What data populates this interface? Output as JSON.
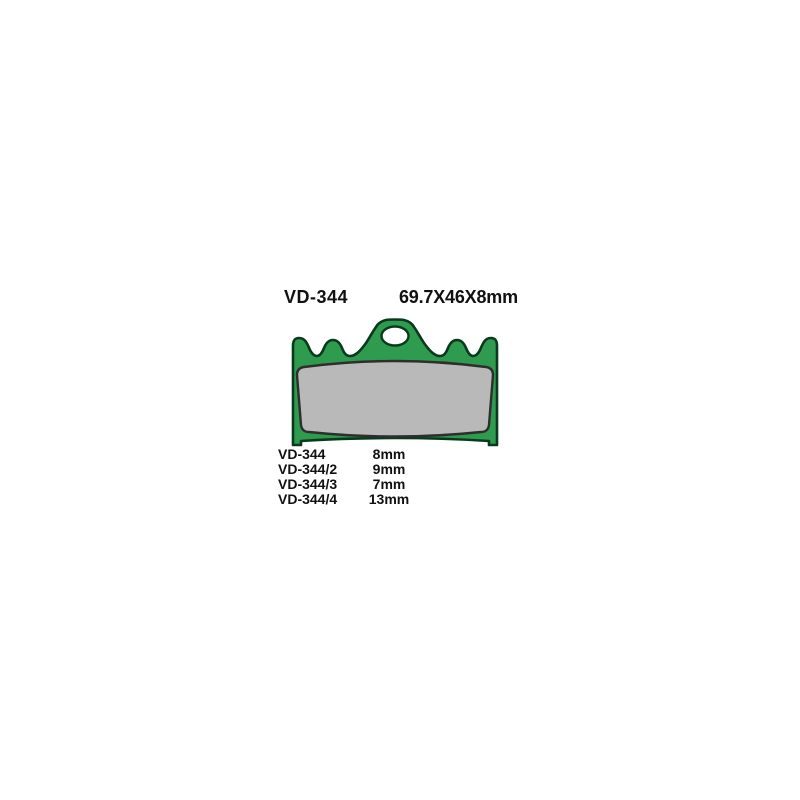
{
  "page": {
    "background": "#ffffff"
  },
  "header": {
    "model_code": "VD-344",
    "dimensions": "69.7X46X8mm"
  },
  "diagram": {
    "description": "brake-pad-top-view",
    "plate_fill": "#2e9b4e",
    "plate_stroke": "#0a3a1e",
    "pad_fill": "#b9b9b9",
    "pad_stroke": "#2e2e2e",
    "hole_fill": "#ffffff"
  },
  "variants": {
    "rows": [
      {
        "model": "VD-344",
        "thickness": "8mm"
      },
      {
        "model": "VD-344/2",
        "thickness": "9mm"
      },
      {
        "model": "VD-344/3",
        "thickness": "7mm"
      },
      {
        "model": "VD-344/4",
        "thickness": "13mm"
      }
    ]
  }
}
